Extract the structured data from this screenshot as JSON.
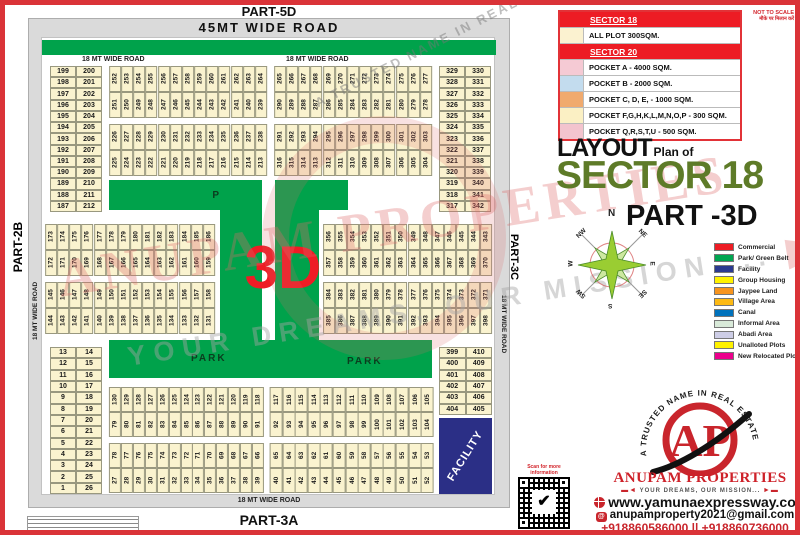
{
  "meta": {
    "not_to_scale": "NOT TO SCALE",
    "hindi_note": "मौके पर मिलान करें"
  },
  "sector_table": {
    "rows": [
      {
        "header": "SECTOR 18"
      },
      {
        "swatch": "#fbf2d0",
        "label": "ALL PLOT  300SQM."
      },
      {
        "header": "SECTOR 20"
      },
      {
        "swatch": "#f5cad4",
        "label": "POCKET A    -   4000 SQM."
      },
      {
        "swatch": "#c3dcee",
        "label": "POCKET B    -   2000 SQM."
      },
      {
        "swatch": "#f0aa6e",
        "label": "POCKET C, D, E, - 1000 SQM."
      },
      {
        "swatch": "#fbf0c4",
        "label": "POCKET  F,G,H,K,L,M,N,O,P  -  300 SQM."
      },
      {
        "swatch": "#f3c4ce",
        "label": "POCKET Q,R,S,T,U   -  500 SQM."
      }
    ]
  },
  "title": {
    "layout": "LAYOUT",
    "plan_of": "Plan of",
    "sector": "SECTOR 18",
    "part": "PART -3D"
  },
  "compass": {
    "n": "N",
    "ne": "NE",
    "e": "E",
    "se": "SE",
    "s": "S",
    "sw": "SW",
    "w": "W",
    "nw": "NW"
  },
  "legend": {
    "items": [
      {
        "color": "#ed1c24",
        "label": "Commercial"
      },
      {
        "color": "#00a651",
        "label": "Park/ Green Belt"
      },
      {
        "color": "#2b3990",
        "label": "Facility"
      },
      {
        "color": "#fff200",
        "label": "Group Housing"
      },
      {
        "color": "#f7941d",
        "label": "Jaypee Land"
      },
      {
        "color": "#fdb913",
        "label": "Village Area"
      },
      {
        "color": "#0072bc",
        "label": "Canal"
      },
      {
        "color": "#d9ead9",
        "label": "Informal Area"
      },
      {
        "color": "#cdcde6",
        "label": "Abadi Area"
      },
      {
        "color": "#fff200",
        "label": "Unalloted Plots"
      },
      {
        "color": "#ec008c",
        "label": "New Relocated Plots"
      }
    ]
  },
  "brand": {
    "arc_text": "A TRUSTED NAME IN REAL ESTATE",
    "logo_text": "AP",
    "name": "ANUPAM PROPERTIES",
    "tagline": "YOUR DREAMS, OUR MISSION...",
    "website": "www.yamunaexpressway.co",
    "email": "anupamproperty2021@gmail.com",
    "phones": "+918860586000 || +918860736000",
    "qr_caption": "Scan for more information"
  },
  "watermark": {
    "line1": "ANUPAM PROPERTIES",
    "line2": "YOUR DREAMS, OUR MISSION ...",
    "arc": "A TRUSTED NAME IN REAL ESTATE"
  },
  "map": {
    "part_top": "PART-5D",
    "part_left": "PART-2B",
    "part_right": "PART-3C",
    "part_bottom": "PART-3A",
    "road_45": "45MT WIDE ROAD",
    "road_18": "18 MT WIDE ROAD",
    "overlay": "3D",
    "park": "PARK",
    "facility": "FACILITY",
    "top_band": {
      "left_pair": {
        "col1": [
          199,
          198,
          197,
          196,
          195,
          194,
          193,
          192,
          191,
          190,
          189,
          188,
          187
        ],
        "col2": [
          200,
          201,
          202,
          203,
          204,
          205,
          206,
          207,
          208,
          209,
          210,
          211,
          212
        ]
      },
      "group1": [
        [
          252,
          253,
          254,
          255,
          256,
          257,
          258,
          259,
          260,
          261,
          262,
          263,
          264
        ],
        [
          251,
          250,
          249,
          248,
          247,
          246,
          245,
          244,
          243,
          242,
          241,
          240,
          239
        ],
        [
          226,
          227,
          228,
          229,
          230,
          231,
          232,
          233,
          234,
          235,
          236,
          237,
          238
        ],
        [
          225,
          224,
          223,
          222,
          221,
          220,
          219,
          218,
          217,
          216,
          215,
          214,
          213
        ]
      ],
      "group2": [
        [
          265,
          266,
          267,
          268,
          269,
          270,
          271,
          272,
          273,
          274,
          275,
          276,
          277
        ],
        [
          290,
          289,
          288,
          287,
          286,
          285,
          284,
          283,
          282,
          281,
          280,
          279,
          278
        ],
        [
          291,
          292,
          293,
          294,
          295,
          296,
          297,
          298,
          299,
          300,
          301,
          302,
          303
        ],
        [
          316,
          315,
          314,
          313,
          312,
          311,
          310,
          309,
          308,
          307,
          306,
          305,
          304
        ]
      ],
      "right_pair": {
        "col1": [
          329,
          328,
          327,
          326,
          325,
          324,
          323,
          322,
          321,
          320,
          319,
          318,
          317
        ],
        "col2": [
          330,
          331,
          332,
          333,
          334,
          335,
          336,
          337,
          338,
          339,
          340,
          341,
          342
        ]
      }
    },
    "mid_band": {
      "left": [
        [
          173,
          174,
          175,
          176,
          177,
          178,
          179,
          180,
          181,
          182,
          183,
          184,
          185,
          186
        ],
        [
          172,
          171,
          170,
          169,
          168,
          167,
          166,
          165,
          164,
          163,
          162,
          161,
          160,
          159
        ],
        [
          145,
          146,
          147,
          148,
          149,
          150,
          151,
          152,
          153,
          154,
          155,
          156,
          157,
          158
        ],
        [
          144,
          143,
          142,
          141,
          140,
          139,
          138,
          137,
          136,
          135,
          134,
          133,
          132,
          131
        ]
      ],
      "right": [
        [
          356,
          355,
          354,
          353,
          352,
          351,
          350,
          349,
          348,
          347,
          346,
          345,
          344,
          343
        ],
        [
          357,
          358,
          359,
          360,
          361,
          362,
          363,
          364,
          365,
          366,
          367,
          368,
          369,
          370
        ],
        [
          384,
          383,
          382,
          381,
          380,
          379,
          378,
          377,
          376,
          375,
          374,
          373,
          372,
          371
        ],
        [
          385,
          386,
          387,
          388,
          389,
          390,
          391,
          392,
          393,
          394,
          395,
          396,
          397,
          398
        ]
      ]
    },
    "bottom_band": {
      "left_pair": {
        "col1": [
          13,
          12,
          11,
          10,
          9,
          8,
          7,
          6,
          5,
          4,
          3,
          2,
          1
        ],
        "col2": [
          14,
          15,
          16,
          17,
          18,
          19,
          20,
          21,
          22,
          23,
          24,
          25,
          26
        ]
      },
      "group1": [
        [
          130,
          129,
          128,
          127,
          126,
          125,
          124,
          123,
          122,
          121,
          120,
          119,
          118
        ],
        [
          79,
          80,
          81,
          82,
          83,
          84,
          85,
          86,
          87,
          88,
          89,
          90,
          91
        ],
        [
          78,
          77,
          76,
          75,
          74,
          73,
          72,
          71,
          70,
          69,
          68,
          67,
          66
        ],
        [
          27,
          28,
          29,
          30,
          31,
          32,
          33,
          34,
          35,
          36,
          37,
          38,
          39
        ]
      ],
      "group2": [
        [
          117,
          116,
          115,
          114,
          113,
          112,
          111,
          110,
          109,
          108,
          107,
          106,
          105
        ],
        [
          92,
          93,
          94,
          95,
          96,
          97,
          98,
          99,
          100,
          101,
          102,
          103,
          104
        ],
        [
          65,
          64,
          63,
          62,
          61,
          60,
          59,
          58,
          57,
          56,
          55,
          54,
          53
        ],
        [
          40,
          41,
          42,
          43,
          44,
          45,
          46,
          47,
          48,
          49,
          50,
          51,
          52
        ]
      ],
      "right_pair": {
        "col1": [
          399,
          400,
          401,
          402,
          403,
          404
        ],
        "col2": [
          410,
          409,
          408,
          407,
          406,
          405
        ]
      }
    }
  }
}
